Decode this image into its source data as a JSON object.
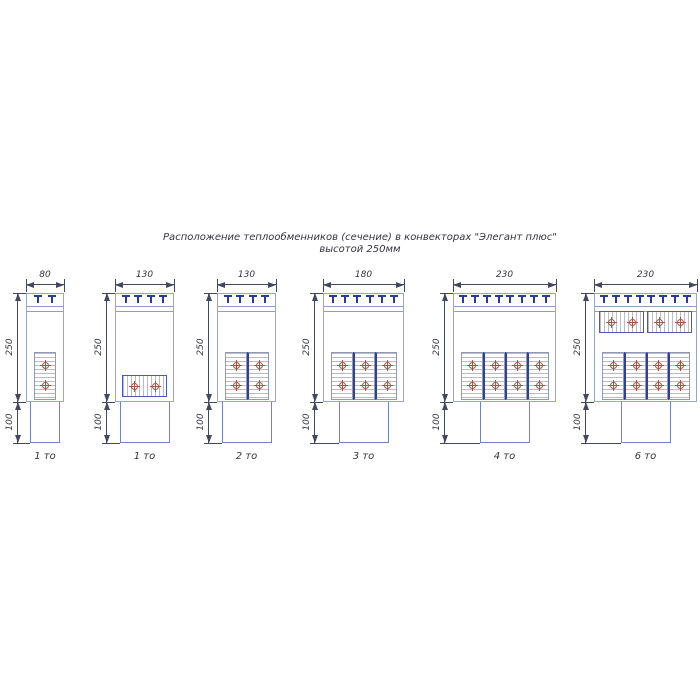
{
  "title": {
    "line1": "Расположение теплообменников (сечение) в конвекторах \"Элегант плюс\"",
    "line2": "высотой 250мм"
  },
  "colors": {
    "drawing_outline": "#98a5cc",
    "duct_outline": "#7282c6",
    "grille_teeth": "#2b3a9c",
    "block_divider": "#2e3f9e",
    "hatch": "#bcbcbc",
    "tube": "#9c5848",
    "dimension_line": "#44485c",
    "text": "#35353f"
  },
  "convectors": [
    {
      "width_label": "80",
      "height_label": "250",
      "duct_height_label": "100",
      "name": "1 то",
      "grille_teeth": 2,
      "exchanger_rows": [
        {
          "position": "bottom",
          "orientation": "vertical",
          "blocks": 1,
          "tubes_per_block": 2
        }
      ]
    },
    {
      "width_label": "130",
      "height_label": "250",
      "duct_height_label": "100",
      "name": "1 то",
      "grille_teeth": 4,
      "exchanger_rows": [
        {
          "position": "bottom",
          "orientation": "horizontal",
          "blocks": 1,
          "tubes_per_block": 2
        }
      ]
    },
    {
      "width_label": "130",
      "height_label": "250",
      "duct_height_label": "100",
      "name": "2 то",
      "grille_teeth": 4,
      "exchanger_rows": [
        {
          "position": "bottom",
          "orientation": "vertical",
          "blocks": 2,
          "tubes_per_block": 2
        }
      ]
    },
    {
      "width_label": "180",
      "height_label": "250",
      "duct_height_label": "100",
      "name": "3 то",
      "grille_teeth": 6,
      "exchanger_rows": [
        {
          "position": "bottom",
          "orientation": "vertical",
          "blocks": 3,
          "tubes_per_block": 2
        }
      ]
    },
    {
      "width_label": "230",
      "height_label": "250",
      "duct_height_label": "100",
      "name": "4 то",
      "grille_teeth": 8,
      "exchanger_rows": [
        {
          "position": "bottom",
          "orientation": "vertical",
          "blocks": 4,
          "tubes_per_block": 2
        }
      ]
    },
    {
      "width_label": "230",
      "height_label": "250",
      "duct_height_label": "100",
      "name": "6 то",
      "grille_teeth": 8,
      "exchanger_rows": [
        {
          "position": "top",
          "orientation": "horizontal",
          "blocks": 2,
          "tubes_per_block": 2
        },
        {
          "position": "bottom",
          "orientation": "vertical",
          "blocks": 4,
          "tubes_per_block": 2
        }
      ]
    }
  ]
}
